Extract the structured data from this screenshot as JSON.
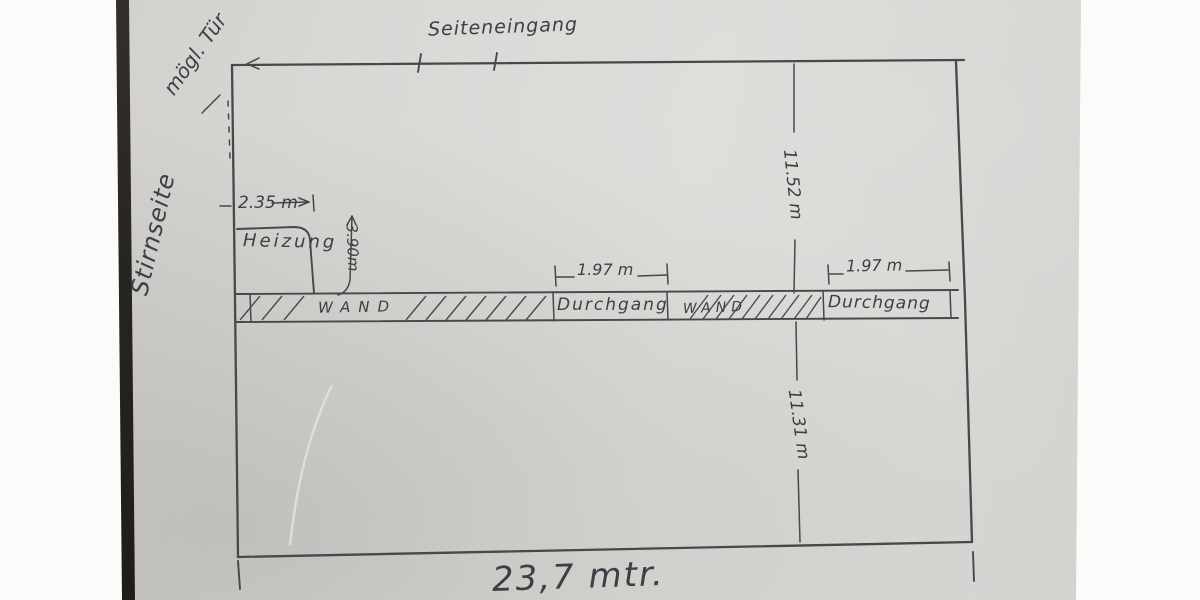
{
  "scene": {
    "description": "Photographed hand-drawn pencil floor plan sketch on grey paper"
  },
  "labels": {
    "possible_door": "mögl. Tür",
    "side_entrance": "Seiteneingang",
    "front_side": "Stirnseite",
    "heating": "Heizung",
    "wall_left": "WAND",
    "passage_left": "Durchgang",
    "wall_right": "WAND",
    "passage_right": "Durchgang"
  },
  "dimensions": {
    "heating_width": "2.35 m",
    "heating_depth": "3.90m",
    "passage_left_width": "1.97 m",
    "passage_right_width": "1.97 m",
    "room_depth_upper": "11.52 m",
    "room_depth_lower": "11.31 m",
    "total_width": "23,7 mtr."
  },
  "colors": {
    "background": "#fbfbfa",
    "paper": "#d7d6d3",
    "paper_edge_dark": "#2a2521",
    "pencil": "#47474c"
  }
}
